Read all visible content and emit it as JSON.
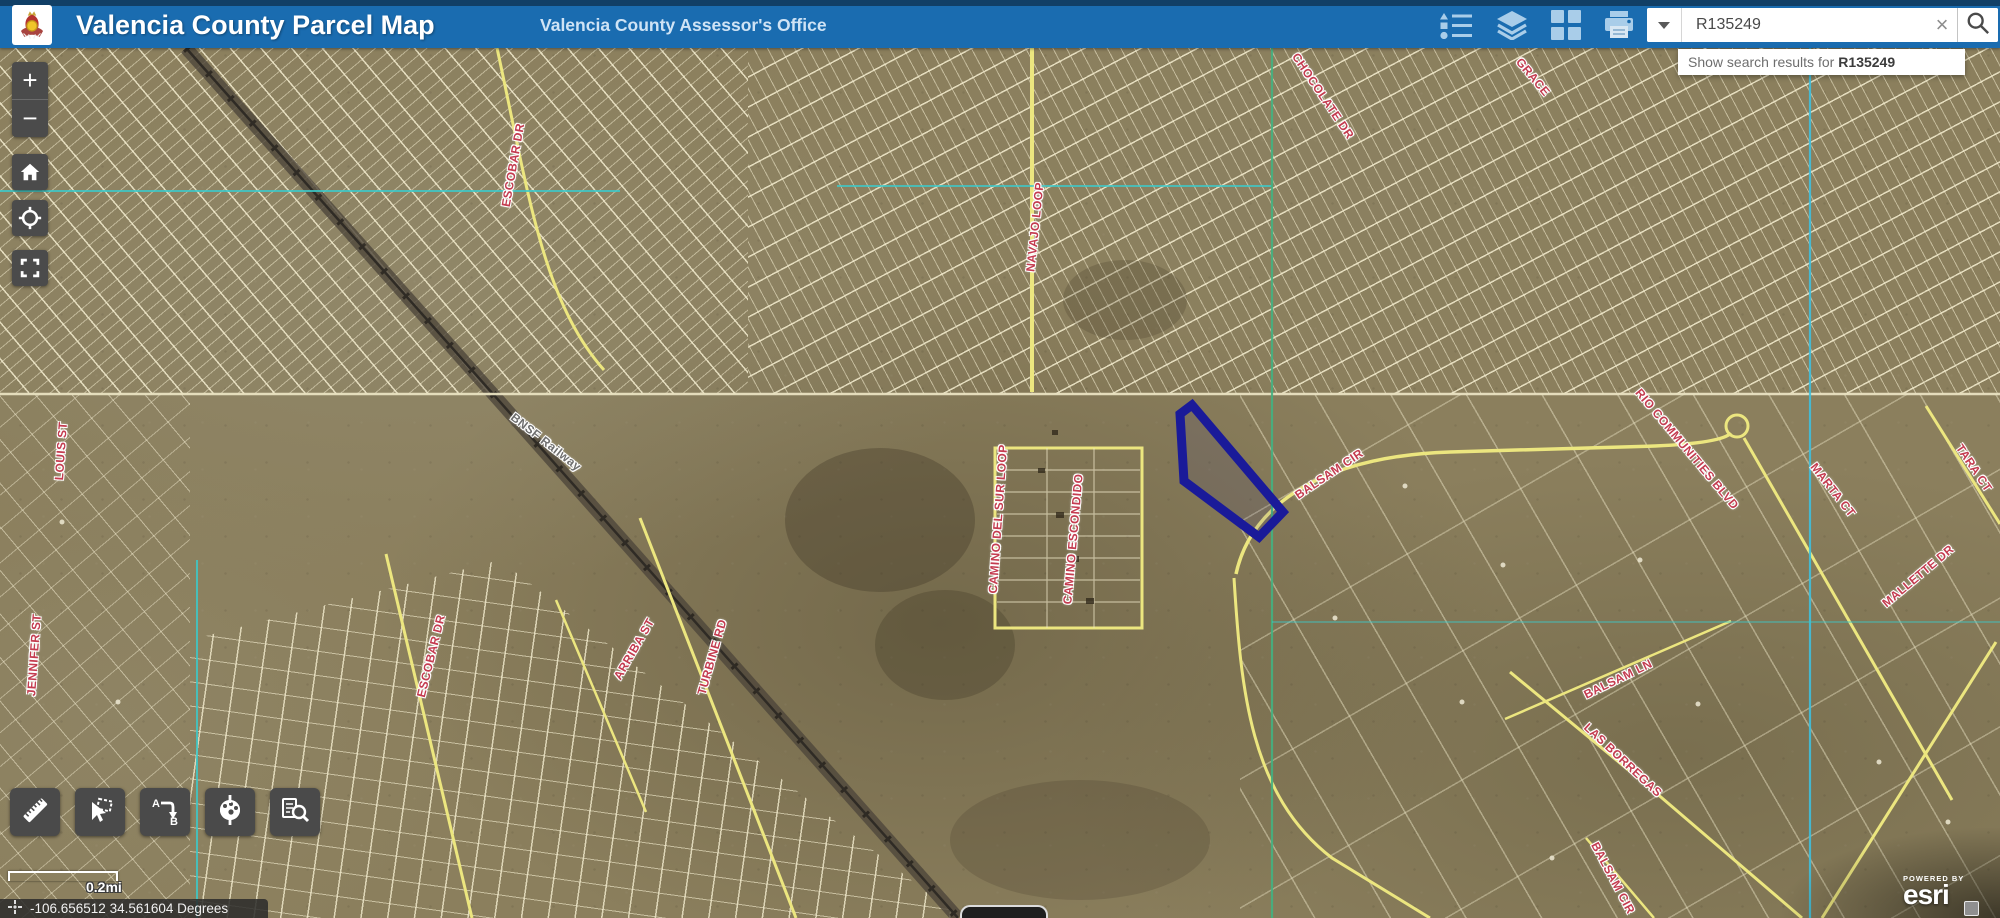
{
  "header": {
    "logo": "valencia-county-seal",
    "title": "Valencia County Parcel Map",
    "subtitle": "Valencia County Assessor's Office",
    "tools": [
      "legend",
      "layers",
      "basemap-gallery",
      "print"
    ],
    "search": {
      "value": "R135249",
      "clear_label": "×",
      "suggestion_prefix": "Show search results for",
      "suggestion_term": "R135249"
    }
  },
  "map_controls": {
    "zoom_in": "+",
    "zoom_out": "−",
    "buttons": [
      "home",
      "locate",
      "default-extent"
    ]
  },
  "tool_dock": [
    "measure",
    "select",
    "directions",
    "draw",
    "attribute-search"
  ],
  "scale_bar": {
    "label": "0.2mi"
  },
  "status_bar": {
    "coordinates": "-106.656512 34.561604 Degrees"
  },
  "attribution": {
    "powered_by": "POWERED BY",
    "brand": "esri"
  },
  "map": {
    "colors": {
      "highlight_parcel": "#1a1a99",
      "roads": "#ece67f",
      "parcel_lines": "#f3ecce",
      "section_line_teal": "#3cc9c9",
      "section_line_green": "#43b181",
      "railway": "#2e2a24"
    },
    "labels": [
      {
        "text": "ESCOBAR DR",
        "x": 513,
        "y": 165,
        "rot": -80,
        "kind": "street"
      },
      {
        "text": "NAVAJO LOOP",
        "x": 1035,
        "y": 227,
        "rot": -84,
        "kind": "street"
      },
      {
        "text": "CHOCOLATE DR",
        "x": 1323,
        "y": 96,
        "rot": 56,
        "kind": "street"
      },
      {
        "text": "GRACE",
        "x": 1533,
        "y": 77,
        "rot": 50,
        "kind": "street"
      },
      {
        "text": "BNSF Railway",
        "x": 546,
        "y": 442,
        "rot": 38,
        "kind": "rail"
      },
      {
        "text": "LOUIS ST",
        "x": 61,
        "y": 451,
        "rot": -86,
        "kind": "street"
      },
      {
        "text": "JENNIFER ST",
        "x": 34,
        "y": 655,
        "rot": -86,
        "kind": "street"
      },
      {
        "text": "ESCOBAR DR",
        "x": 431,
        "y": 656,
        "rot": -76,
        "kind": "street"
      },
      {
        "text": "ARRIBA ST",
        "x": 634,
        "y": 649,
        "rot": -60,
        "kind": "street"
      },
      {
        "text": "TURBINE RD",
        "x": 712,
        "y": 657,
        "rot": -74,
        "kind": "street"
      },
      {
        "text": "CAMINO DEL SUR LOOP",
        "x": 998,
        "y": 519,
        "rot": -86,
        "kind": "street"
      },
      {
        "text": "CAMINO ESCONDIDO",
        "x": 1073,
        "y": 539,
        "rot": -85,
        "kind": "street"
      },
      {
        "text": "BALSAM CIR",
        "x": 1329,
        "y": 474,
        "rot": -34,
        "kind": "street"
      },
      {
        "text": "RIO COMMUNITIES BLVD",
        "x": 1687,
        "y": 449,
        "rot": 50,
        "kind": "street"
      },
      {
        "text": "MARTA CT",
        "x": 1833,
        "y": 490,
        "rot": 52,
        "kind": "street"
      },
      {
        "text": "TARA CT",
        "x": 1974,
        "y": 468,
        "rot": 56,
        "kind": "street"
      },
      {
        "text": "MALLETTE DR",
        "x": 1918,
        "y": 576,
        "rot": -40,
        "kind": "street"
      },
      {
        "text": "BALSAM LN",
        "x": 1618,
        "y": 679,
        "rot": -26,
        "kind": "street"
      },
      {
        "text": "LAS BORREGAS",
        "x": 1623,
        "y": 760,
        "rot": 43,
        "kind": "street"
      },
      {
        "text": "BALSAM CIR",
        "x": 1613,
        "y": 878,
        "rot": 62,
        "kind": "street"
      }
    ]
  }
}
